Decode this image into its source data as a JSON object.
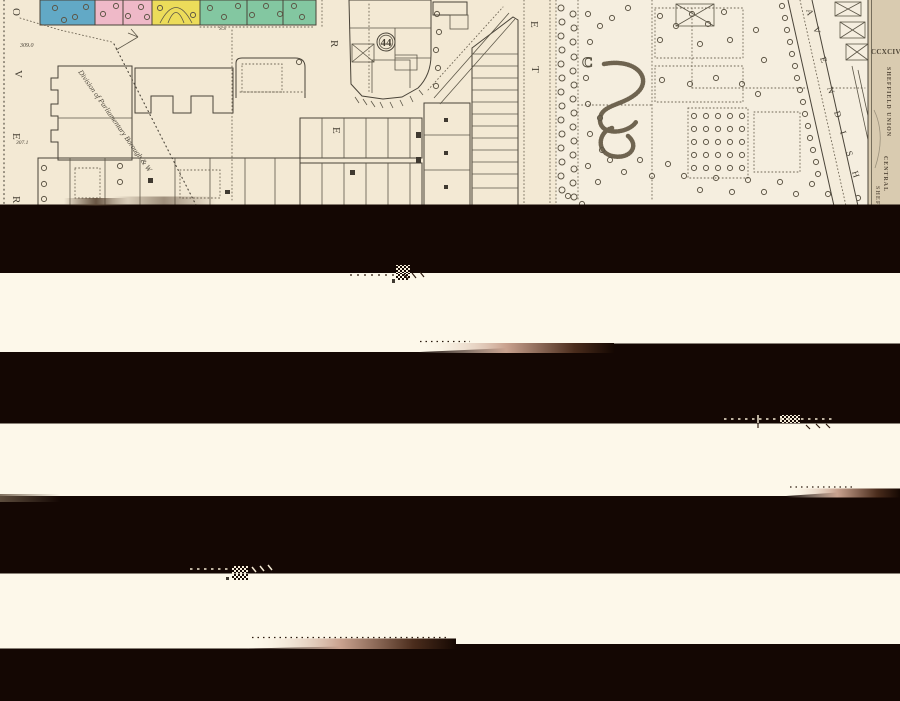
{
  "map": {
    "sheet_number": "CCXCIV.",
    "margin_texts": {
      "union": "SHEFFIELD UNION",
      "ward": "CENTRAL",
      "fragment": "SHEF"
    },
    "parcel_number": "44",
    "boundary_label": "Division of Parliamentary Borough & W",
    "street_letters": {
      "left": [
        "O",
        "V",
        "E",
        "R"
      ],
      "mid": [
        "R",
        "E"
      ],
      "east": [
        "E",
        "T"
      ],
      "road": [
        "A",
        "V",
        "E",
        "N",
        "D",
        "I",
        "S",
        "H"
      ]
    },
    "block_letter": "C",
    "spot_levels": {
      "upper": "309.0",
      "lower": "307.1"
    },
    "survey_label": "S.S",
    "colors": {
      "paper": "#f3e9d4",
      "garden_paper": "#f5eedf",
      "margin_paper": "#d9cbb0",
      "band_cream": "#fdf8ea",
      "band_black": "#140703",
      "parcel_blue": "#62a9c6",
      "parcel_pink": "#efb9c8",
      "parcel_yellow": "#ecdc5a",
      "parcel_green": "#83c7a1",
      "parcel_green_44": "#8bcba6",
      "ink": "#4a4439"
    }
  }
}
